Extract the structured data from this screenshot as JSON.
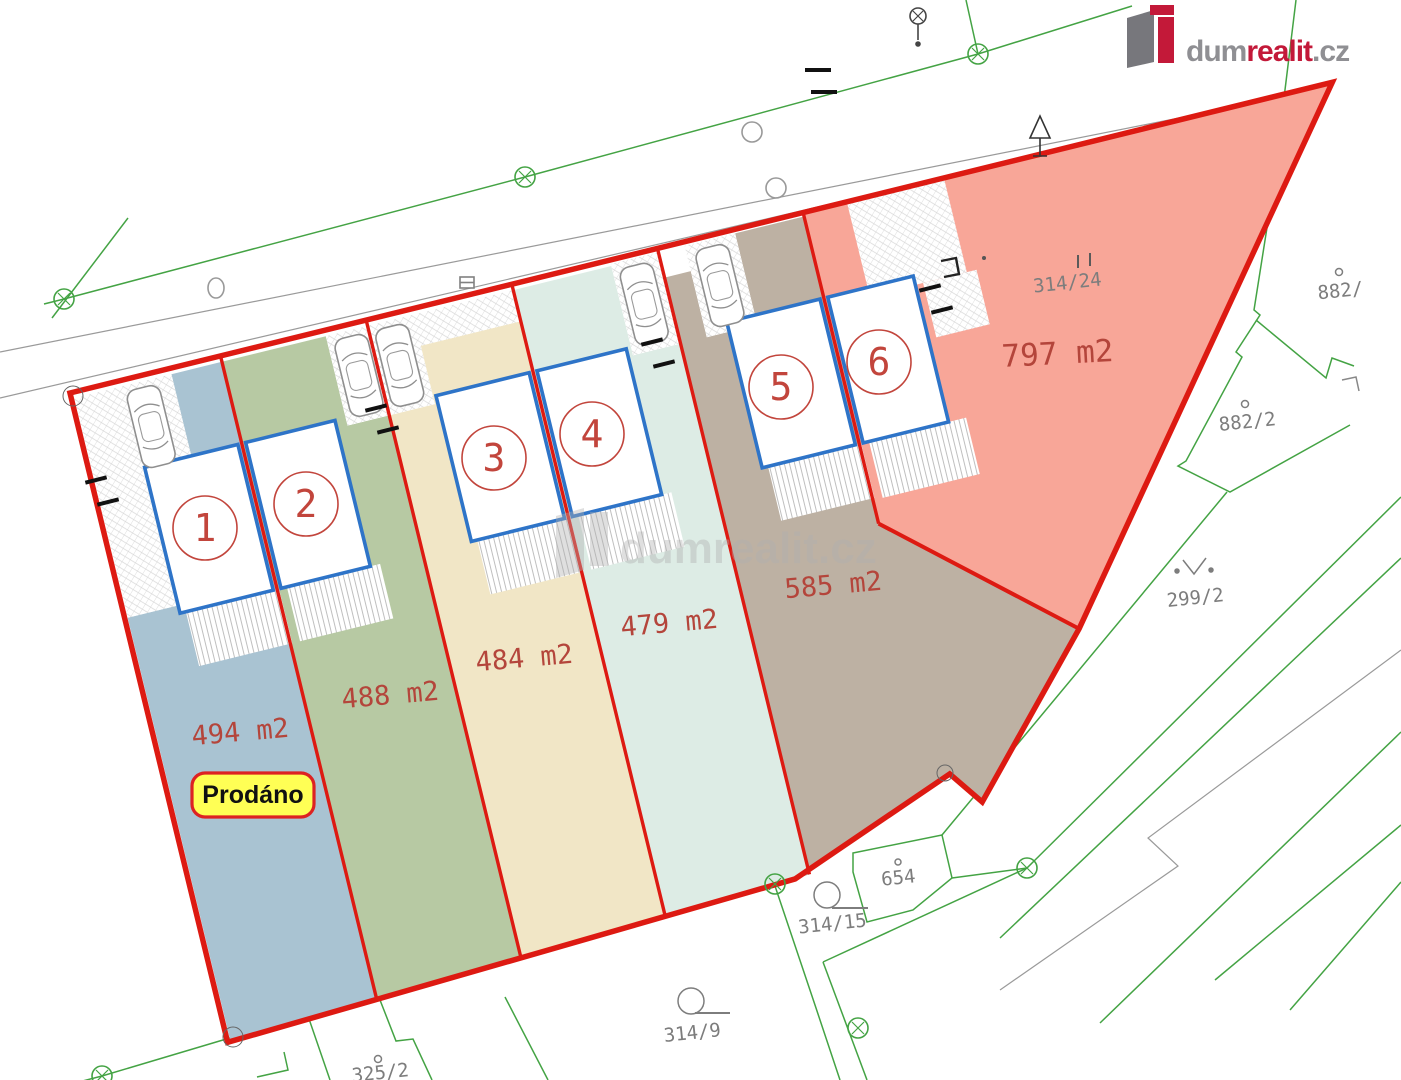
{
  "brand": {
    "logo_prefix": "dum",
    "logo_accent": "realit",
    "logo_suffix": ".cz"
  },
  "watermark": {
    "text": "dumrealit.cz"
  },
  "status_badge": {
    "label": "Prodáno"
  },
  "plots": [
    {
      "number": "1",
      "area_label": "494 m2",
      "fill": "#a9c3d2"
    },
    {
      "number": "2",
      "area_label": "488 m2",
      "fill": "#b7c9a3"
    },
    {
      "number": "3",
      "area_label": "484 m2",
      "fill": "#f1e6c6"
    },
    {
      "number": "4",
      "area_label": "479 m2",
      "fill": "#ddece5"
    },
    {
      "number": "5",
      "area_label": "585 m2",
      "fill": "#bdb1a3"
    },
    {
      "number": "6",
      "area_label": "797 m2",
      "fill": "#f8a698"
    }
  ],
  "parcels": [
    {
      "label": "314/24"
    },
    {
      "label": "882/"
    },
    {
      "label": "882/2"
    },
    {
      "label": "299/2"
    },
    {
      "label": "654"
    },
    {
      "label": "314/15"
    },
    {
      "label": "314/9"
    },
    {
      "label": "325/2"
    }
  ],
  "colors": {
    "boundary_red": "#dd1a12",
    "house_blue": "#2e74c8",
    "number_red": "#c2453c",
    "area_text": "#b4453b",
    "parcel_text": "#7d7d7d",
    "survey_green": "#44a344",
    "road_gray": "#9a9a9a",
    "badge_yellow": "#ffff55",
    "badge_border": "#dd2222",
    "logo_gray": "#8f8f93",
    "logo_red": "#c31939",
    "watermark_gray": "#b0b0b0"
  }
}
